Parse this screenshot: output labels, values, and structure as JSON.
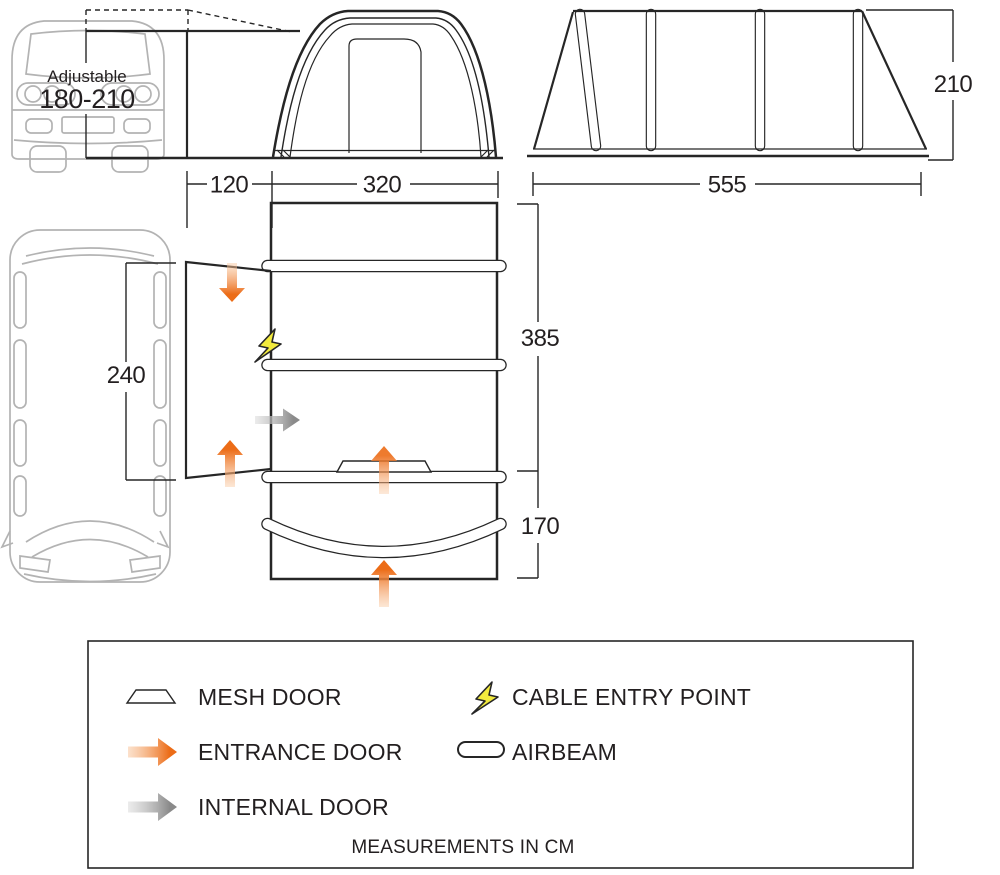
{
  "colors": {
    "line": "#262626",
    "van_line": "#b3b3b3",
    "text": "#231f20",
    "entrance_dark": "#ec6c17",
    "entrance_light": "#f9c9a2",
    "internal_dark": "#8a8a8a",
    "internal_light": "#dcdcdc",
    "cable_yellow": "#f2ea3d"
  },
  "van_front": {
    "label": "Adjustable",
    "value": "180-210"
  },
  "dimensions_cm": {
    "tunnel_width": "120",
    "front_width": "320",
    "side_length": "555",
    "height": "210",
    "door_opening": "240",
    "main_depth": "385",
    "porch_depth": "170"
  },
  "legend": {
    "mesh_door": "MESH DOOR",
    "entrance_door": "ENTRANCE DOOR",
    "internal_door": "INTERNAL DOOR",
    "cable_entry": "CABLE ENTRY POINT",
    "airbeam": "AIRBEAM",
    "footnote": "MEASUREMENTS IN CM"
  }
}
